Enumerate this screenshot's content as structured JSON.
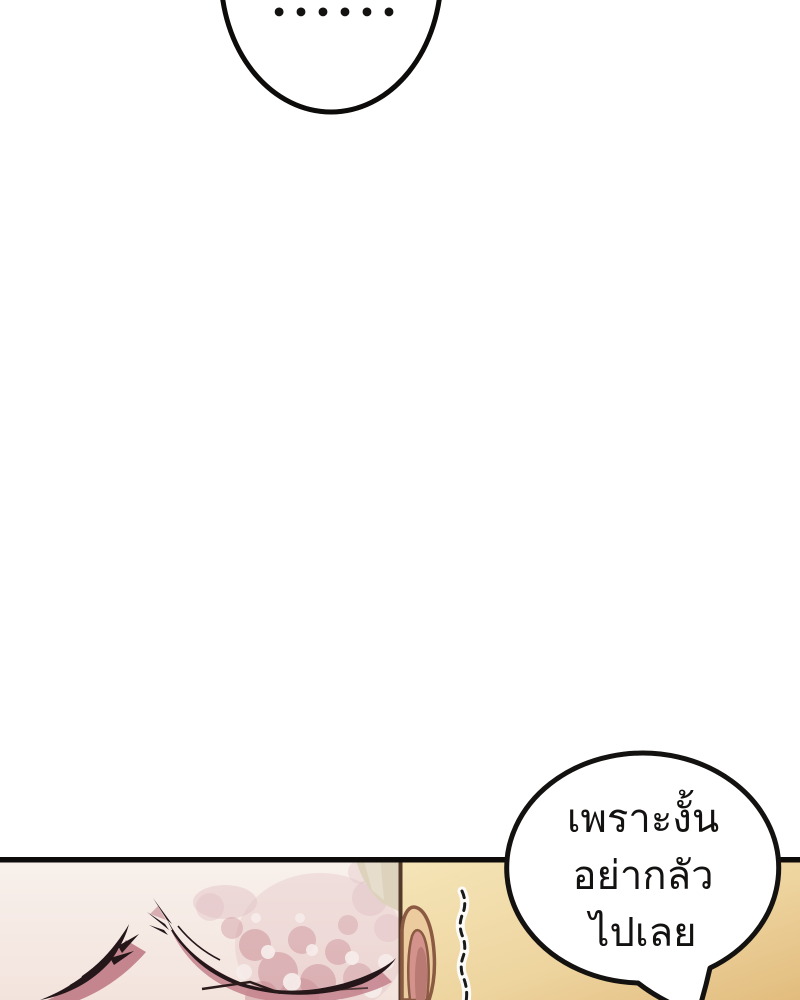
{
  "top_bubble": {
    "dots": "••••••"
  },
  "speech_bubble": {
    "lines": [
      "เพราะงั้น",
      "อย่ากลัว",
      "ไปเลย"
    ]
  },
  "palette": {
    "page-bg": "#ffffff",
    "ink": "#141210",
    "panel-border": "#0e0c0b",
    "bubble-fill": "#ffffff",
    "tan-light": "#f5e5b8",
    "tan-dark": "#e2bc7e",
    "skin-light": "#f8f1ec",
    "skin-dark": "#f3e3dd",
    "blush": "#c5858f",
    "lash": "#241619",
    "pillar-beige": "#ddd3bd",
    "divider-brown": "#52392a",
    "ear-outline": "#8a5a42",
    "ear-fill": "#eccb9f",
    "ear-inner-pink": "#d4928c",
    "ear-inner-deep": "#b97a74"
  }
}
